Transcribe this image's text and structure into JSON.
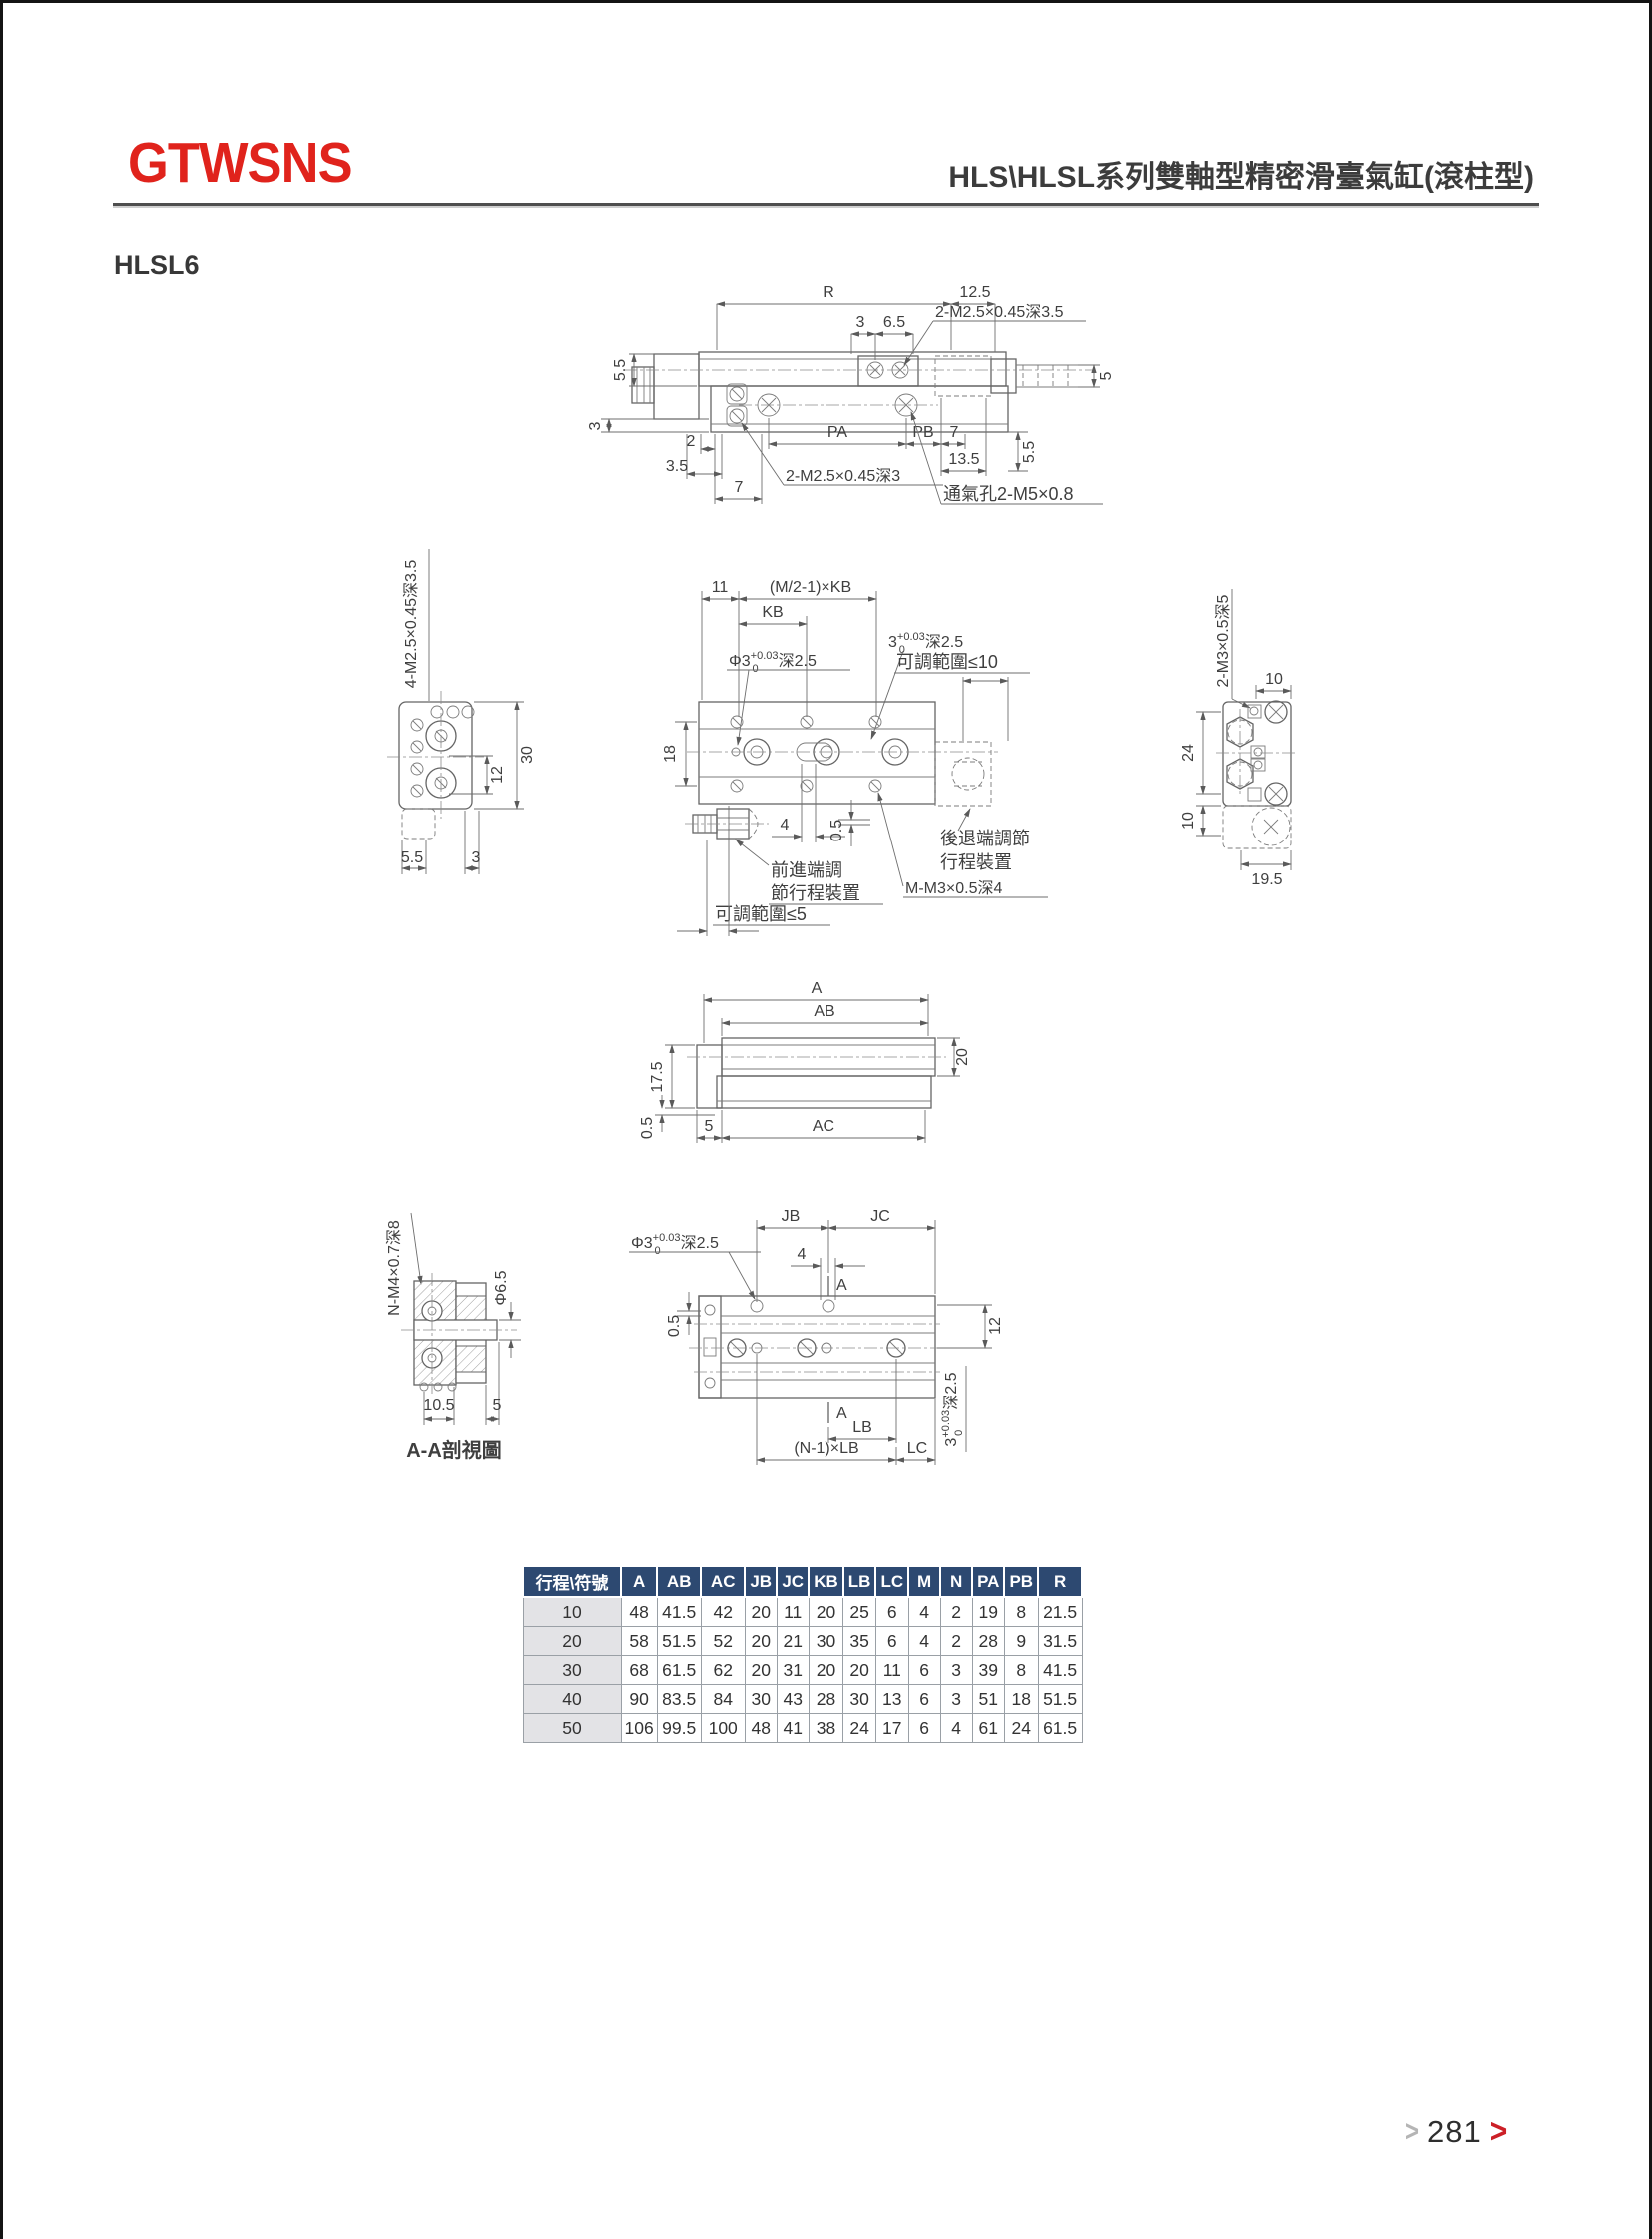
{
  "header": {
    "brand": "GTWSNS",
    "title": "HLS\\HLSL系列雙軸型精密滑臺氣缸(滾柱型)",
    "model": "HLSL6"
  },
  "colors": {
    "brand_red": "#e0231c",
    "table_header_bg": "#2d4971",
    "row_label_bg": "#e3e3e6",
    "line_gray": "#656565",
    "page_chevron_red": "#cc2027"
  },
  "d1": {
    "r": "R",
    "d125": "12.5",
    "d3": "3",
    "d65": "6.5",
    "thread_top": "2-M2.5×0.45深3.5",
    "d55": "5.5",
    "d5": "5",
    "d3b": "3",
    "d2": "2",
    "d35": "3.5",
    "d7": "7",
    "pa": "PA",
    "pb": "PB",
    "d7b": "7",
    "d135": "13.5",
    "d55b": "5.5",
    "thread_bot": "2-M2.5×0.45深3",
    "vent": "通氣孔2-M5×0.8"
  },
  "d2": {
    "thread": "4-M2.5×0.45深3.5",
    "d30": "30",
    "d12": "12",
    "d55": "5.5",
    "d3": "3"
  },
  "d3": {
    "d11": "11",
    "mkb": "(M/2-1)×KB",
    "kb": "KB",
    "phi_base": "Φ3",
    "phi_sup": "+0.03",
    "phi_sub": "0",
    "phi_tail": "深2.5",
    "t3_base": "3",
    "t3_sup": "+0.03",
    "t3_sub": "0",
    "t3_tail": "深2.5",
    "adj10": "可調範圍≤10",
    "d18": "18",
    "d4": "4",
    "d05": "0.5",
    "fwd1": "前進端調",
    "fwd2": "節行程裝置",
    "back1": "後退端調節",
    "back2": "行程裝置",
    "mm3": "M-M3×0.5深4",
    "adj5": "可調範圍≤5"
  },
  "d4": {
    "thread": "2-M3×0.5深5",
    "d10": "10",
    "d24": "24",
    "d10b": "10",
    "d195": "19.5"
  },
  "d5": {
    "a": "A",
    "ab": "AB",
    "d175": "17.5",
    "d05": "0.5",
    "d5": "5",
    "ac": "AC",
    "d20": "20"
  },
  "d6": {
    "thread": "N-M4×0.7深8",
    "phi65": "Φ6.5",
    "d105": "10.5",
    "d5": "5",
    "caption": "A-A剖視圖"
  },
  "d7": {
    "phi_base": "Φ3",
    "phi_sup": "+0.03",
    "phi_sub": "0",
    "phi_tail": "深2.5",
    "jb": "JB",
    "jc": "JC",
    "d4": "4",
    "a_top": "A",
    "d05": "0.5",
    "d12": "12",
    "t3_base": "3",
    "t3_sup": "+0.03",
    "t3_sub": "0",
    "t3_tail": "深2.5",
    "a_bot": "A",
    "lb": "LB",
    "nlb": "(N-1)×LB",
    "lc": "LC"
  },
  "table": {
    "headers": [
      "行程\\符號",
      "A",
      "AB",
      "AC",
      "JB",
      "JC",
      "KB",
      "LB",
      "LC",
      "M",
      "N",
      "PA",
      "PB",
      "R"
    ],
    "rows": [
      [
        "10",
        "48",
        "41.5",
        "42",
        "20",
        "11",
        "20",
        "25",
        "6",
        "4",
        "2",
        "19",
        "8",
        "21.5"
      ],
      [
        "20",
        "58",
        "51.5",
        "52",
        "20",
        "21",
        "30",
        "35",
        "6",
        "4",
        "2",
        "28",
        "9",
        "31.5"
      ],
      [
        "30",
        "68",
        "61.5",
        "62",
        "20",
        "31",
        "20",
        "20",
        "11",
        "6",
        "3",
        "39",
        "8",
        "41.5"
      ],
      [
        "40",
        "90",
        "83.5",
        "84",
        "30",
        "43",
        "28",
        "30",
        "13",
        "6",
        "3",
        "51",
        "18",
        "51.5"
      ],
      [
        "50",
        "106",
        "99.5",
        "100",
        "48",
        "41",
        "38",
        "24",
        "17",
        "6",
        "4",
        "61",
        "24",
        "61.5"
      ]
    ]
  },
  "footer": {
    "page": "281",
    "chev": "❯"
  }
}
